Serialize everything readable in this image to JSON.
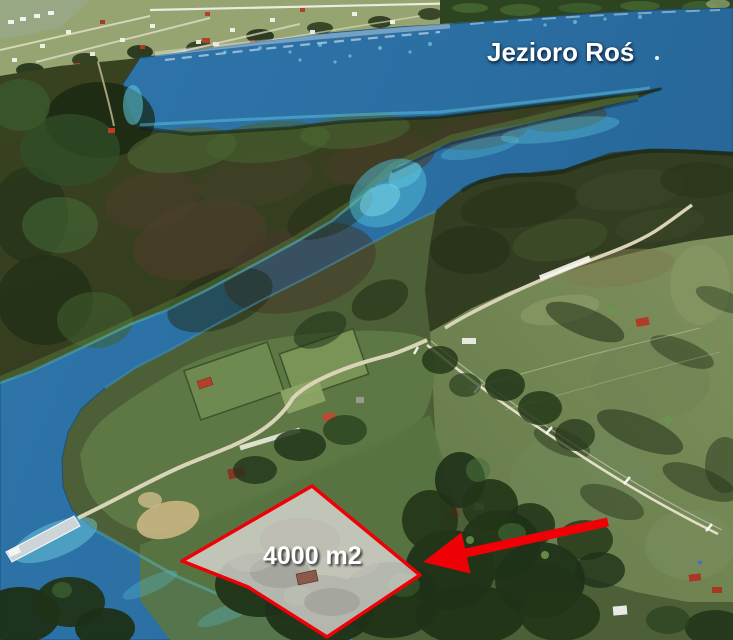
{
  "scene": {
    "description": "Annotated aerial photo of a lakefront building plot for sale",
    "lake_label": "Jezioro Roś",
    "plot_label": "4000 m2"
  },
  "colors": {
    "annotation_red": "#ee0006",
    "plot_fill": "rgba(223,221,216,0.78)",
    "label_white": "#ffffff",
    "water_blue": "#2b6fa3",
    "shallow_cyan": "#55c4da",
    "field_green": "#74885a",
    "forest_dark": "#27381c"
  }
}
